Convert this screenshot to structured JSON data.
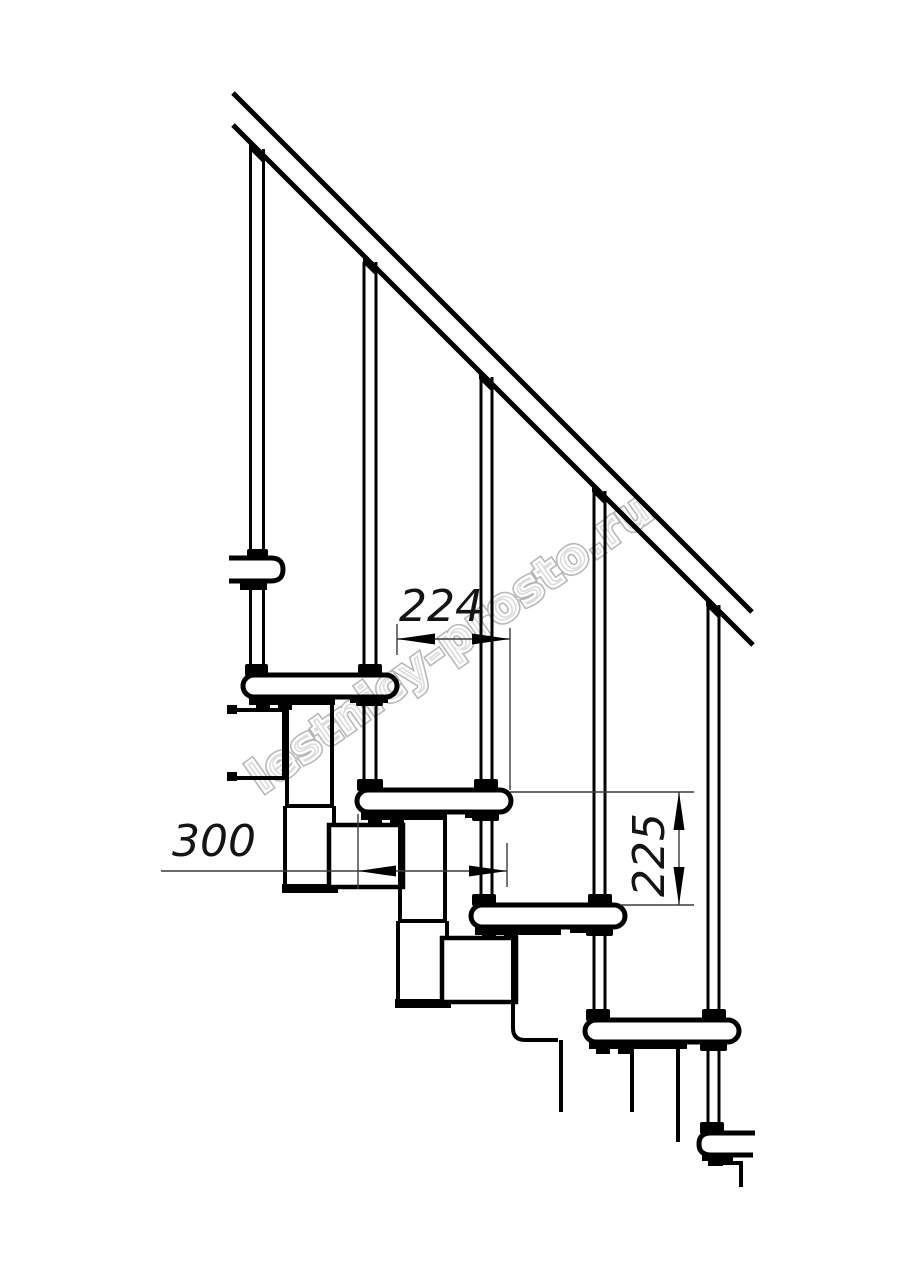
{
  "drawing": {
    "type": "technical-drawing",
    "subject": "modular staircase side view with handrail, balusters, treads and support modules",
    "watermark": "lestnicy-prosto.ru",
    "dimensions": {
      "step_offset": "224",
      "tread_depth": "300",
      "riser_height": "225"
    },
    "colors": {
      "background": "#ffffff",
      "line": "#000000",
      "dimension_line": "#3c3c3c",
      "watermark_outline": "#ababab"
    }
  }
}
